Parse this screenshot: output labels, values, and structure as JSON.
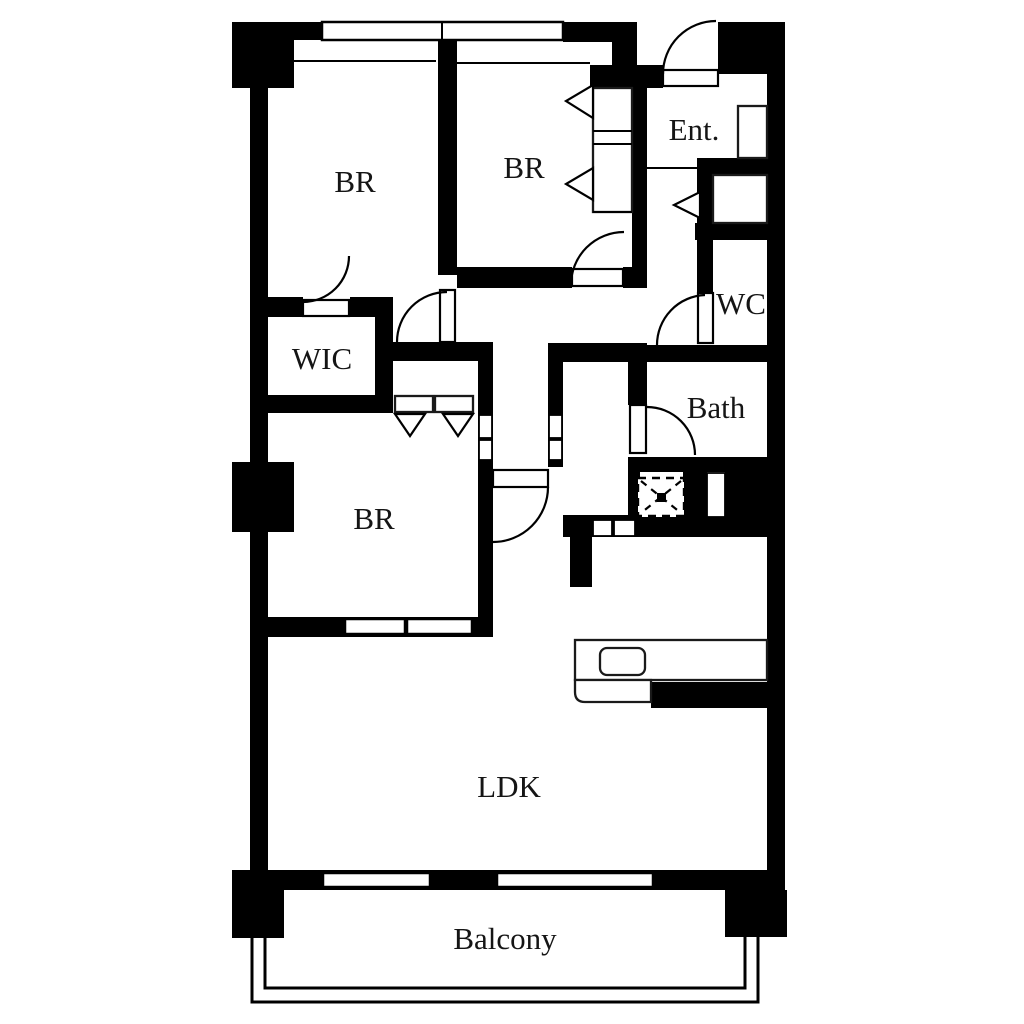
{
  "plan": {
    "kind": "apartment-floor-plan",
    "colors": {
      "wall": "#000000",
      "floor": "#ffffff",
      "line": "#151515"
    },
    "rooms": {
      "bedroom_top_left": {
        "label": "BR"
      },
      "bedroom_top_middle": {
        "label": "BR"
      },
      "entrance": {
        "label": "Ent."
      },
      "wc": {
        "label": "WC"
      },
      "walk_in_closet": {
        "label": "WIC"
      },
      "bath": {
        "label": "Bath"
      },
      "bedroom_lower_left": {
        "label": "BR"
      },
      "living_dining_kitchen": {
        "label": "LDK"
      },
      "balcony": {
        "label": "Balcony"
      }
    }
  }
}
